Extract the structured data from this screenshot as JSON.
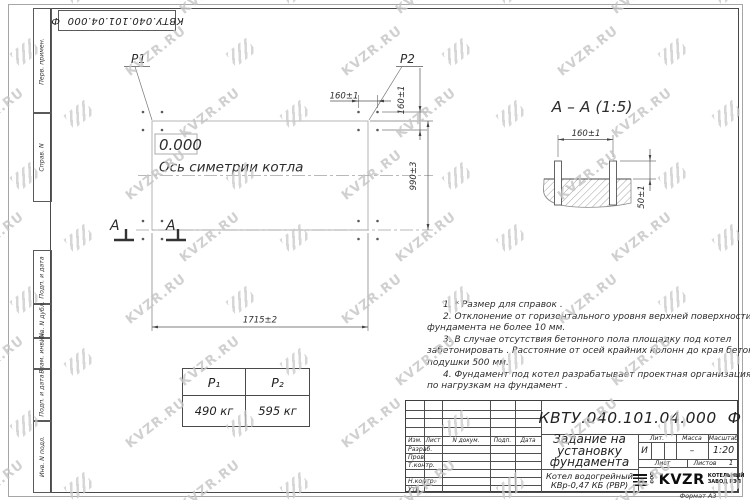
{
  "stamp_top": "КВТУ.040.101.04.000  Ф",
  "watermark": {
    "text": "KVZR.RU",
    "icon": "stripes-icon"
  },
  "margin_fields": [
    "Перв. примен.",
    "Справ. N",
    "Подп. и дата",
    "Инв. N дубл.",
    "Взам. инв. N",
    "Подп. и дата",
    "Инв. N подл."
  ],
  "plan": {
    "p1_label": "P1",
    "p2_label": "P2",
    "elevation": "0.000",
    "axis_label": "Ось симетрии котла",
    "dim_160_top": "160±1",
    "dim_160_side": "160±1",
    "dim_990": "990±3",
    "dim_1715": "1715±2",
    "section_letter_1": "A",
    "section_letter_2": "A"
  },
  "section": {
    "title": "A – A (1:5)",
    "dim_160": "160±1",
    "dim_50": "50±1"
  },
  "notes_lines": [
    "1. * Размер для справок .",
    "2. Отклонение от горизонтального уровня верхней поверхности",
    "фундамента не более 10 мм.",
    "3. В случае отсутствия бетонного пола площадку под котел",
    "забетонировать . Расстояние от осей крайних колонн до края бетонной",
    "подушки  500 мм.",
    "4. Фундамент под котел разрабатывает проектная организация",
    "по нагрузкам на фундамент ."
  ],
  "load_table": {
    "headers": [
      "P₁",
      "P₂"
    ],
    "values": [
      "490 кг",
      "595 кг"
    ]
  },
  "title_block": {
    "designation": "КВТУ.040.101.04.000  Ф",
    "title_lines": [
      "Задание на",
      "установку",
      "фундамента"
    ],
    "product_lines": [
      "Котел водогрейный",
      "КВр-0,47 КБ (РВР)"
    ],
    "header_row": [
      "Изм.",
      "Лист",
      "N докум.",
      "Подп.",
      "Дата"
    ],
    "rows": [
      "Разраб.",
      "Пров.",
      "Т.контр.",
      "",
      "Н.контр.",
      "Утв."
    ],
    "lit_header": "Лит.",
    "mass_header": "Масса",
    "scale_header": "Масштаб",
    "lit": "И",
    "mass": "–",
    "scale": "1:20",
    "sheet_label": "Лист",
    "sheets_label": "Листов",
    "sheets_value": "1",
    "logo_ooo": "ООО",
    "logo_text": "KVZR",
    "logo_sub1": "КОТЕЛЬНЫЙ",
    "logo_sub2": "ЗАВОД РЭП",
    "format": "Формат А3"
  },
  "colors": {
    "line": "#555555",
    "light_line": "#b4b4b4",
    "watermark": "#c5c5c5"
  }
}
